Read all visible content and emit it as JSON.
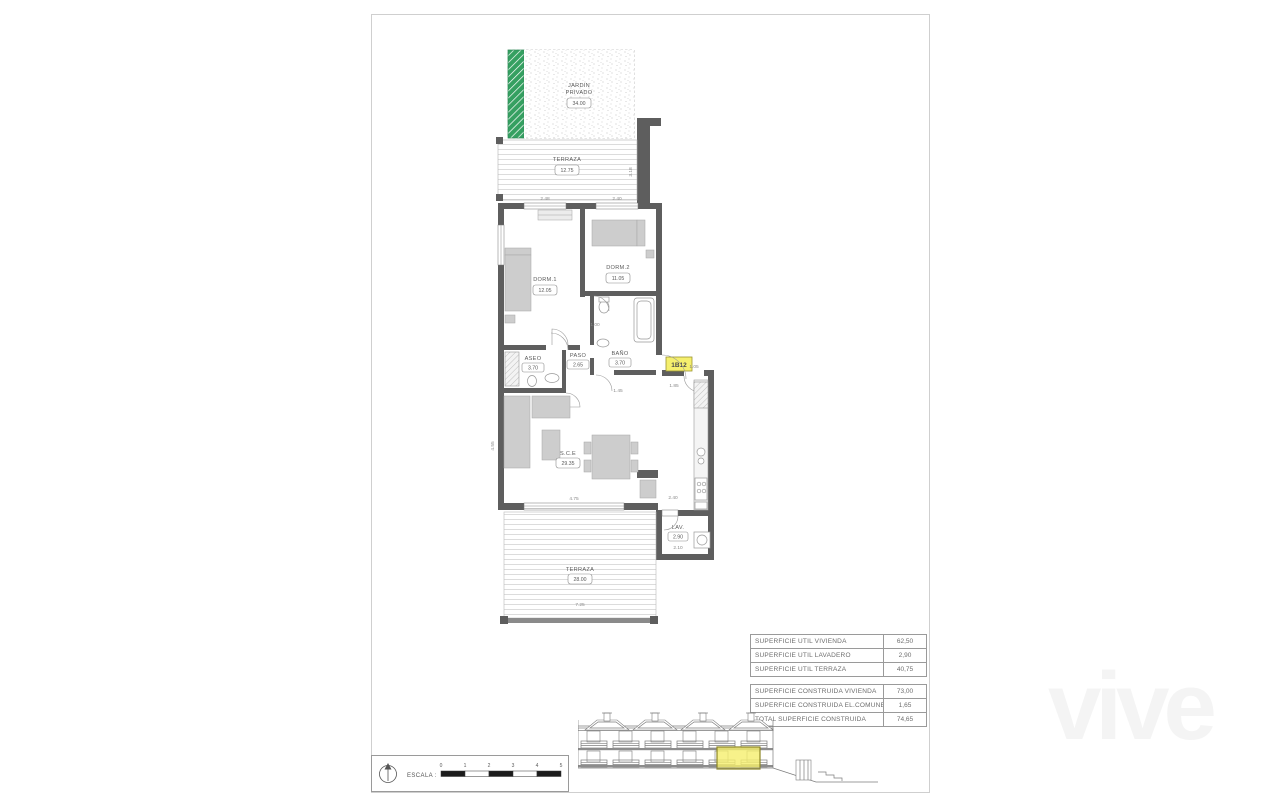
{
  "sheet": {
    "watermark": "vive"
  },
  "plan": {
    "unit_tag": "1B12",
    "jardin": {
      "name_line1": "JARDIN",
      "name_line2": "PRIVADO",
      "area": "34.00"
    },
    "terraza_sup": {
      "name": "TERRAZA",
      "area": "12.75"
    },
    "dorm1": {
      "name": "DORM.1",
      "area": "12.05"
    },
    "dorm2": {
      "name": "DORM.2",
      "area": "11.05"
    },
    "aseo": {
      "name": "ASEO",
      "area": "3.70"
    },
    "paso": {
      "name": "PASO",
      "area": "2.65"
    },
    "bano": {
      "name": "BAÑO",
      "area": "3.70"
    },
    "sce": {
      "name": "S.C.E",
      "area": "29.35"
    },
    "lav": {
      "name": "LAV.",
      "area": "2.90"
    },
    "terraza_inf": {
      "name": "TERRAZA",
      "area": "28.00"
    },
    "dims": {
      "dorm1_width": "2.48",
      "dorm2_width": "2.40",
      "terraza_sup_depth": "3.18",
      "paso_entry": "1.00",
      "hall": "1.45",
      "entry": "1.85",
      "kitchen_door": "1.05",
      "living_width": "4.75",
      "terrace_door": "5.00",
      "kitchen_depth": "2.40",
      "lav_width": "2.10",
      "terrace_width": "7.25",
      "living_depth": "4.55"
    }
  },
  "area_table": {
    "util_rows": [
      {
        "label": "SUPERFICIE UTIL VIVIENDA",
        "value": "62,50"
      },
      {
        "label": "SUPERFICIE UTIL LAVADERO",
        "value": "2,90"
      },
      {
        "label": "SUPERFICIE UTIL TERRAZA",
        "value": "40,75"
      }
    ],
    "construida_rows": [
      {
        "label": "SUPERFICIE CONSTRUIDA VIVIENDA",
        "value": "73,00"
      },
      {
        "label": "SUPERFICIE CONSTRUIDA EL.COMUNES",
        "value": "1,65"
      },
      {
        "label": "TOTAL SUPERFICIE CONSTRUIDA",
        "value": "74,65"
      }
    ]
  },
  "scale_bar": {
    "label": "ESCALA :",
    "ticks": [
      "0",
      "1",
      "2",
      "3",
      "4",
      "5"
    ]
  },
  "colors": {
    "wall": "#5e5e5e",
    "garden_green": "#35a061",
    "highlight_yellow": "#f5ef6d",
    "line": "#9a9a9a"
  }
}
